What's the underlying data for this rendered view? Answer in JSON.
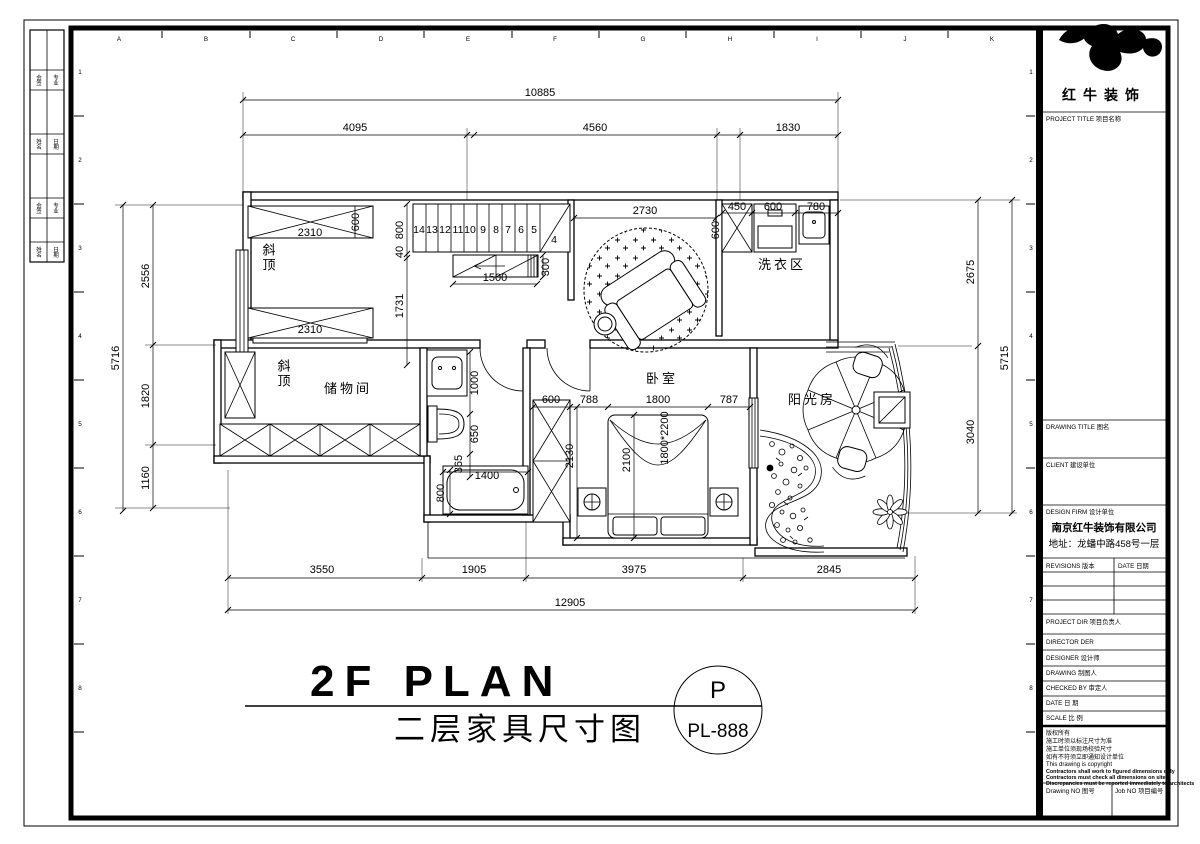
{
  "sheet": {
    "border_letters": [
      "A",
      "B",
      "C",
      "D",
      "E",
      "F",
      "G",
      "H",
      "I",
      "J",
      "K"
    ],
    "border_numbers": [
      "1",
      "2",
      "3",
      "4",
      "5",
      "6",
      "7",
      "8"
    ],
    "signoff": [
      "会签",
      "专业",
      "姓名",
      "日期",
      "会签",
      "专业",
      "姓名",
      "日期"
    ]
  },
  "titleblock": {
    "logo_name": "红牛装饰",
    "project_title": "PROJECT TITLE 项目名称",
    "drawing_title": "DRAWING TITLE 图名",
    "client": "CLIENT 建设单位",
    "design_firm": "DESIGN FIRM 设计单位",
    "firm_name": "南京红牛装饰有限公司",
    "firm_address": "地址：龙蟠中路458号一层",
    "revisions": "REVISIONS 版本",
    "rev_date": "DATE 日期",
    "project_dir": "PROJECT DIR 项目负责人",
    "director": "DIRECTOR DER",
    "designer": "DESIGNER 设计师",
    "drawing_by": "DRAWING 制图人",
    "checked_by": "CHECKED BY 审定人",
    "date": "DATE 日 期",
    "scale": "SCALE 比 例",
    "note1": "版权所有",
    "note2": "施工时须以标注尺寸为准",
    "note3": "施工单位须现场校验尺寸",
    "note4": "如有不符须立即通知设计单位",
    "note5": "This drawing is copyright",
    "note6": "Contractors shall work to figured dimensions only",
    "note7": "Contractors must check all dimensions on site",
    "note8": "Discrepancies must be reported immediately to architects",
    "drawing_no": "Drawing NO 图号",
    "job_no": "Job NO 项目编号"
  },
  "plan_title": {
    "en": "2F PLAN",
    "cn": "二层家具尺寸图",
    "bubble_top": "P",
    "bubble_bottom": "PL-888"
  },
  "rooms": {
    "sloped_top": "斜顶",
    "sloped_storage": "斜顶",
    "storage": "储物间",
    "laundry": "洗衣区",
    "bedroom": "卧室",
    "sunroom": "阳光房",
    "bed_size": "1800*2200"
  },
  "stairs": [
    "14",
    "13",
    "12",
    "11",
    "10",
    "9",
    "8",
    "7",
    "6",
    "5",
    "4"
  ],
  "dims": {
    "top_overall": "10885",
    "top_1": "4095",
    "top_2": "4560",
    "top_3": "1830",
    "bottom_1": "3550",
    "bottom_2": "1905",
    "bottom_3": "3975",
    "bottom_4": "2845",
    "bottom_overall": "12905",
    "left_overall": "5716",
    "left_1": "2556",
    "left_2": "1820",
    "left_3": "1160",
    "right_1": "2675",
    "right_2": "3040",
    "right_overall": "5715",
    "cab_top": "2310",
    "cab_depth": "600",
    "cab_bottom": "2310",
    "stair_w": "800",
    "stair_gap": "40",
    "hall_h": "1731",
    "rail": "1500",
    "rail_d": "300",
    "living": "2730",
    "laundry_1": "450",
    "laundry_2": "600",
    "laundry_3": "780",
    "laundry_d": "600",
    "basin": "1000",
    "toilet": "650",
    "gap": "365",
    "tub_l": "1400",
    "tub_w": "800",
    "ward_w": "600",
    "ward_h": "2130",
    "bed_l": "788",
    "bed_w": "1800",
    "bed_r": "787",
    "bed_len": "2100"
  }
}
